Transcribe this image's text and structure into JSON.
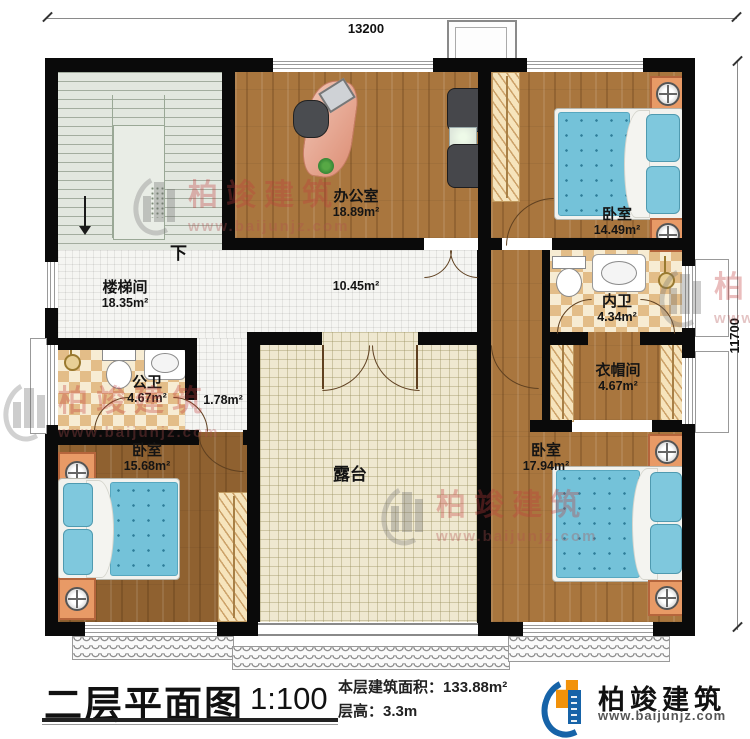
{
  "dimensions": {
    "top": "13200",
    "right": "11700"
  },
  "stairs": {
    "direction_label": "下"
  },
  "rooms": {
    "stairwell": {
      "name": "楼梯间",
      "area": "18.35m²"
    },
    "office": {
      "name": "办公室",
      "area": "18.89m²"
    },
    "bedroom_top_right": {
      "name": "卧室",
      "area": "14.49m²"
    },
    "hallway": {
      "area": "10.45m²"
    },
    "inner_bathroom": {
      "name": "内卫",
      "area": "4.34m²"
    },
    "public_bathroom": {
      "name": "公卫",
      "area": "4.67m²"
    },
    "corridor": {
      "area": "1.78m²"
    },
    "cloakroom": {
      "name": "衣帽间",
      "area": "4.67m²"
    },
    "bedroom_bottom_left": {
      "name": "卧室",
      "area": "15.68m²"
    },
    "bedroom_bottom_right": {
      "name": "卧室",
      "area": "17.94m²"
    },
    "terrace": {
      "name": "露台"
    }
  },
  "title_block": {
    "title": "二层平面图",
    "scale": "1:100",
    "area_label": "本层建筑面积：",
    "area_value": "133.88m²",
    "height_label": "层高：",
    "height_value": "3.3m"
  },
  "brand": {
    "name": "柏竣建筑",
    "website": "www.baijunjz.com"
  },
  "watermark": {
    "name": "柏竣建筑",
    "website": "www.baijunjz.com"
  },
  "colors": {
    "wall": "#0a0a0a",
    "wood_floor": "#a9763e",
    "bed_blue": "#74c2d9",
    "accent_blue": "#1663a8",
    "accent_orange": "#f2920a",
    "watermark_red": "#c23b3b"
  }
}
